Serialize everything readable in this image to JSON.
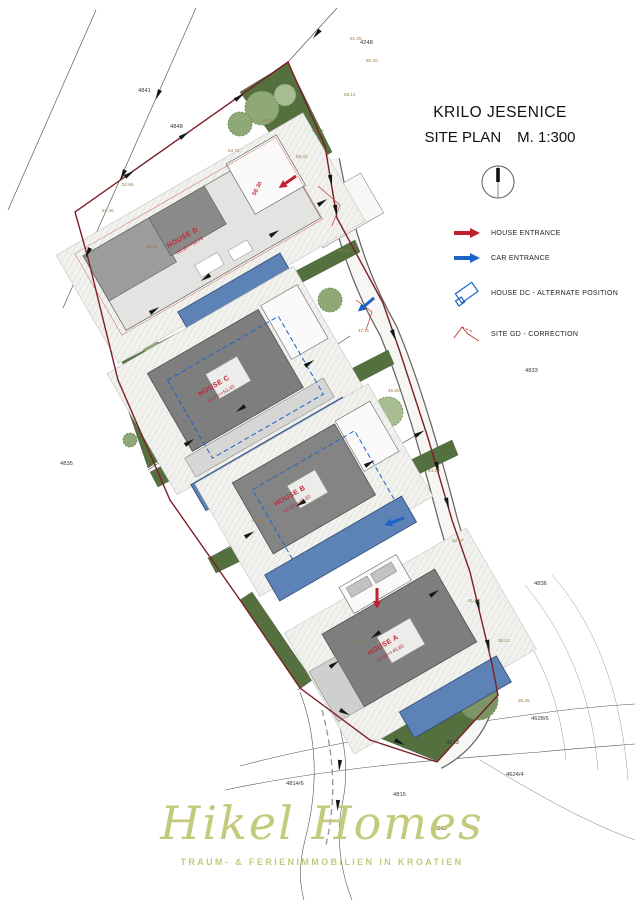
{
  "title": {
    "project": "KRILO JESENICE",
    "sheet": "SITE PLAN",
    "scale": "M. 1:300"
  },
  "legend": {
    "items": [
      {
        "label": "HOUSE ENTRANCE",
        "symbol": "red-arrow",
        "color": "#c01f2f"
      },
      {
        "label": "CAR ENTRANCE",
        "symbol": "blue-arrow",
        "color": "#1e62c8"
      },
      {
        "label": "HOUSE DC - ALTERNATE POSITION",
        "symbol": "blue-rect-outline",
        "color": "#1e62c8"
      },
      {
        "label": "SITE GD - CORRECTION",
        "symbol": "red-lines",
        "color": "#c01f2f"
      }
    ]
  },
  "plan": {
    "houses": [
      {
        "name": "HOUSE A",
        "elevation": "±0,00=+45,80"
      },
      {
        "name": "HOUSE B",
        "elevation": "±0,00=+49,60"
      },
      {
        "name": "HOUSE C",
        "elevation": "±0,00=+53,40"
      },
      {
        "name": "HOUSE D",
        "elevation": "±0,00=+56,70"
      }
    ],
    "road_label": "SE 30",
    "parcels": [
      "4841",
      "4848",
      "4248",
      "4833",
      "4835",
      "4836",
      "4813",
      "4814/6",
      "4815",
      "4818",
      "4624/4",
      "4628/6"
    ],
    "spot_elevations": [
      "91.05",
      "60.40",
      "58.12",
      "57.16",
      "56.41",
      "55.08",
      "53.71",
      "52.66",
      "51.40",
      "49.32",
      "48.25",
      "47.11",
      "45.80",
      "44.39",
      "42.57",
      "41.22",
      "38.12",
      "36.45",
      "61.05",
      "64.02"
    ]
  },
  "logo": {
    "name": "Hikel Homes",
    "tagline": "TRAUM- & FERIENIMMOBILIEN IN KROATIEN",
    "color": "#c3ca7c"
  },
  "colors": {
    "boundary": "#7a2026",
    "green": "#55703f",
    "pool": "#5d82b5",
    "entrance_red": "#c01f2f",
    "entrance_blue": "#1e62c8",
    "label_red": "#c22533",
    "logo": "#c3ca7c"
  }
}
